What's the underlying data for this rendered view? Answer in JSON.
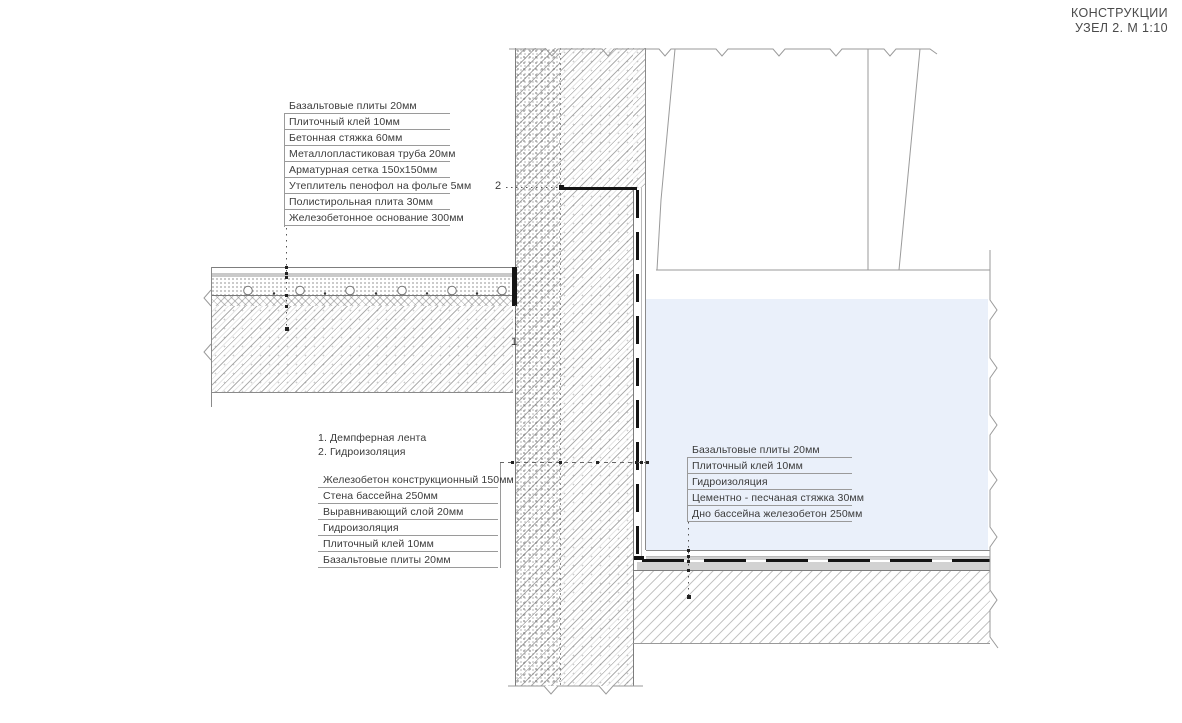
{
  "title": {
    "line1": "КОНСТРУКЦИИ",
    "line2": "УЗЕЛ 2. М 1:10"
  },
  "floor_layers_list": {
    "items": [
      "Базальтовые плиты 20мм",
      "Плиточный клей 10мм",
      "Бетонная стяжка 60мм",
      "Металлопластиковая труба 20мм",
      "Арматурная сетка 150х150мм",
      "Утеплитель пенофол на фольге 5мм",
      "Полистирольная плита 30мм",
      "Железобетонное основание 300мм"
    ]
  },
  "notes": {
    "line1": "1. Демпферная лента",
    "line2": "2. Гидроизоляция"
  },
  "wall_layers_list": {
    "items": [
      "Железобетон конструкционный 150мм",
      "Стена бассейна 250мм",
      "Выравнивающий слой 20мм",
      "Гидроизоляция",
      "Плиточный клей 10мм",
      "Базальтовые плиты 20мм"
    ]
  },
  "pool_floor_layers_list": {
    "items": [
      "Базальтовые плиты 20мм",
      "Плиточный клей 10мм",
      "Гидроизоляция",
      "Цементно - песчаная стяжка 30мм",
      "Дно бассейна железобетон 250мм"
    ]
  },
  "markers": {
    "damper_tape": "1",
    "waterproofing": "2"
  },
  "colors": {
    "water": "#eaf0fa",
    "line": "#7d7d7d",
    "underline": "#9a9a9a",
    "text": "#3b3b3b",
    "black_detail": "#141414",
    "adhesive_gray": "#c9c9c9"
  }
}
